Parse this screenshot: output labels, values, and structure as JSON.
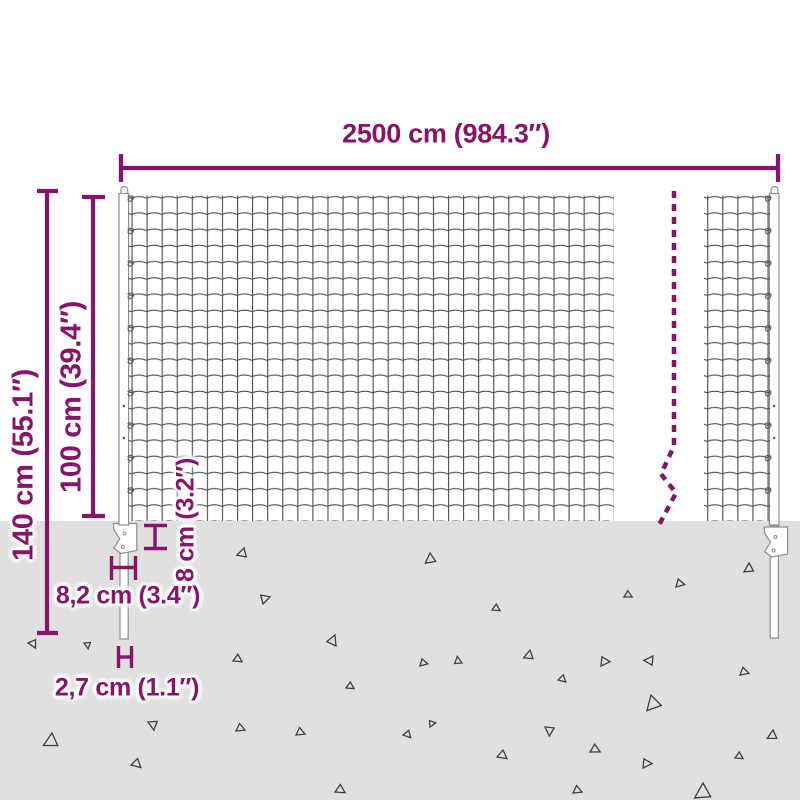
{
  "alt": "Wire mesh fence dimension diagram",
  "colors": {
    "accent": "#871468",
    "wire": "#4d4d4d",
    "ground": "#e0e0e0",
    "post-outline": "#8f8f8f",
    "triangle-outline": "#3f3f3f"
  },
  "dimensions": {
    "width": {
      "label": "2500 cm (984.3″)"
    },
    "total_height": {
      "label": "140 cm (55.1″)"
    },
    "mesh_height": {
      "label": "100 cm (39.4″)"
    },
    "plate_height": {
      "label": "8 cm (3.2″)"
    },
    "plate_width": {
      "label": "8,2 cm (3.4″)"
    },
    "spike_width": {
      "label": "2,7 cm (1.1″)"
    }
  },
  "ground": {
    "triangles": [
      {
        "x": 244,
        "y": 548,
        "r": 20,
        "s": 1.0
      },
      {
        "x": 430,
        "y": 553,
        "r": 0,
        "s": 1.1
      },
      {
        "x": 749,
        "y": 563,
        "r": 5,
        "s": 1.0
      },
      {
        "x": 676,
        "y": 587,
        "r": 230,
        "s": 0.9
      },
      {
        "x": 624,
        "y": 597,
        "r": 245,
        "s": 0.8
      },
      {
        "x": 263,
        "y": 604,
        "r": 200,
        "s": 1.0
      },
      {
        "x": 492,
        "y": 610,
        "r": 250,
        "s": 0.8
      },
      {
        "x": 28,
        "y": 643,
        "r": 280,
        "s": 0.9
      },
      {
        "x": 84,
        "y": 643,
        "r": 300,
        "s": 0.7
      },
      {
        "x": 336,
        "y": 646,
        "r": 150,
        "s": 1.1
      },
      {
        "x": 530,
        "y": 650,
        "r": 15,
        "s": 1.0
      },
      {
        "x": 653,
        "y": 656,
        "r": 40,
        "s": 1.0
      },
      {
        "x": 233,
        "y": 661,
        "r": 250,
        "s": 0.9
      },
      {
        "x": 462,
        "y": 663,
        "r": 120,
        "s": 0.8
      },
      {
        "x": 601,
        "y": 666,
        "r": 220,
        "s": 1.0
      },
      {
        "x": 420,
        "y": 666,
        "r": 230,
        "s": 0.8
      },
      {
        "x": 740,
        "y": 675,
        "r": 235,
        "s": 0.9
      },
      {
        "x": 558,
        "y": 680,
        "r": 260,
        "s": 0.8
      },
      {
        "x": 346,
        "y": 688,
        "r": 250,
        "s": 0.8
      },
      {
        "x": 651,
        "y": 695,
        "r": 350,
        "s": 1.6
      },
      {
        "x": 148,
        "y": 722,
        "r": 300,
        "s": 1.0
      },
      {
        "x": 430,
        "y": 727,
        "r": 210,
        "s": 0.7
      },
      {
        "x": 545,
        "y": 727,
        "r": 310,
        "s": 1.0
      },
      {
        "x": 773,
        "y": 730,
        "r": 10,
        "s": 1.0
      },
      {
        "x": 236,
        "y": 731,
        "r": 240,
        "s": 0.9
      },
      {
        "x": 52,
        "y": 733,
        "r": 10,
        "s": 1.5
      },
      {
        "x": 296,
        "y": 735,
        "r": 240,
        "s": 0.9
      },
      {
        "x": 403,
        "y": 735,
        "r": 265,
        "s": 0.8
      },
      {
        "x": 590,
        "y": 752,
        "r": 245,
        "s": 1.0
      },
      {
        "x": 497,
        "y": 757,
        "r": 255,
        "s": 1.0
      },
      {
        "x": 735,
        "y": 758,
        "r": 250,
        "s": 0.8
      },
      {
        "x": 131,
        "y": 765,
        "r": 260,
        "s": 1.0
      },
      {
        "x": 643,
        "y": 768,
        "r": 220,
        "s": 1.0
      },
      {
        "x": 703,
        "y": 783,
        "r": 5,
        "s": 1.7
      },
      {
        "x": 335,
        "y": 792,
        "r": 250,
        "s": 1.0
      },
      {
        "x": 573,
        "y": 793,
        "r": 240,
        "s": 0.9
      }
    ]
  }
}
